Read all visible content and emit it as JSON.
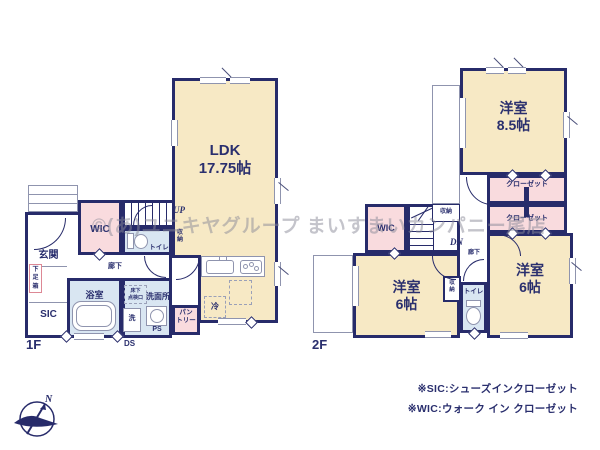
{
  "colors": {
    "wall": "#272b6a",
    "room_beige": "#f7e9c5",
    "room_pink": "#f9dbde",
    "room_blue": "#d9e6f2",
    "label_navy": "#2a2f6e",
    "watermark_gray": "#8a8a98",
    "shoebox_border_pink": "#dd8895"
  },
  "watermark": "©(あ)ユニキヤグループ まいすまいカンパニー尾店",
  "compass": {
    "north_label": "N"
  },
  "floor1": {
    "label": "1F",
    "ldk": {
      "name": "LDK",
      "size": "17.75帖"
    },
    "up": "UP",
    "ds": "DS",
    "wic": "WIC",
    "genkan": "玄関",
    "shoe_box": "下\n足\n箱",
    "sic": "SIC",
    "toilet": "トイレ",
    "under_stair_storage": "収\n納",
    "hallway": "廊下",
    "bath": "浴室",
    "inspection_hatch": "床下\n点検口",
    "washroom": "洗面所",
    "washer": "洗",
    "ps": "PS",
    "pantry": "パン\nトリー",
    "fridge": "冷"
  },
  "floor2": {
    "label": "2F",
    "dn": "DN",
    "bedroom_85": {
      "name": "洋室",
      "size": "8.5帖"
    },
    "closet_upper": "クローゼット",
    "closet_lower": "クローゼット",
    "wic": "WIC",
    "stair_storage": "収納",
    "hallway": "廊下",
    "bedroom_6_left": {
      "name": "洋室",
      "size": "6帖"
    },
    "toilet": "トイレ",
    "small_storage": "収\n納",
    "bedroom_6_right": {
      "name": "洋室",
      "size": "6帖"
    }
  },
  "legend": {
    "sic": "※SIC:シューズインクローゼット",
    "wic": "※WIC:ウォーク イン クローゼット"
  }
}
